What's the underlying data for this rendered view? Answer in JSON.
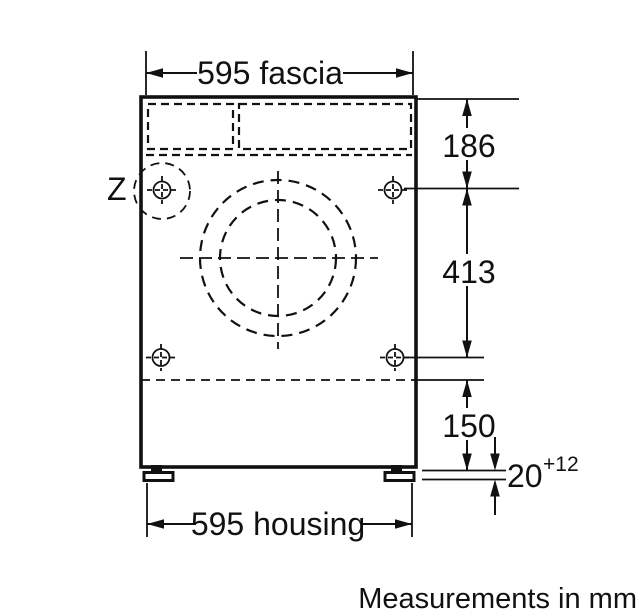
{
  "diagram": {
    "detail_marker": "Z",
    "note": "Measurements in mm",
    "dimensions": {
      "fascia": "595 fascia",
      "housing": "595 housing",
      "top_to_hinge_hole": "186",
      "hole_to_hole": "413",
      "plinth_clearance": "150",
      "gap_value": "20",
      "gap_tolerance": "+12"
    },
    "colors": {
      "line": "#111111",
      "background": "#ffffff"
    }
  }
}
